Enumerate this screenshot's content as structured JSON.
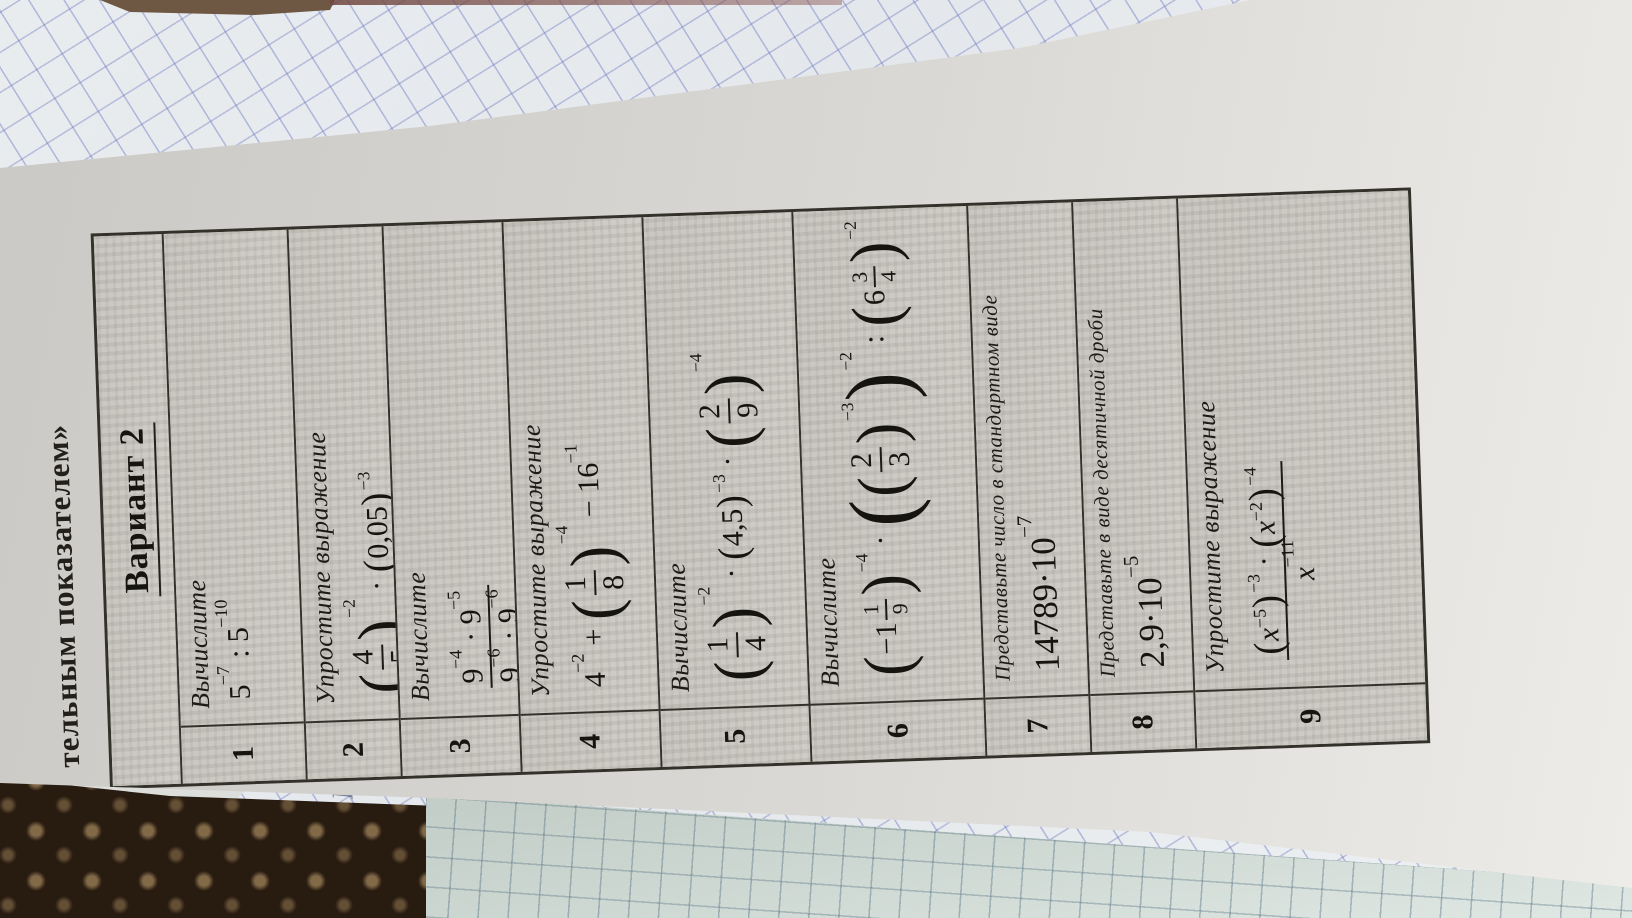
{
  "scene": {
    "page_title_fragment": "тельным показателем»",
    "handwriting_mark": "И"
  },
  "worksheet": {
    "variant_title": "Вариант 2",
    "problems": [
      {
        "num": "1",
        "instruction": "Вычислите",
        "formula": [
          {
            "t": "txt",
            "v": "5"
          },
          {
            "t": "sup",
            "v": "−7"
          },
          {
            "t": "txt",
            "v": " : 5"
          },
          {
            "t": "sup",
            "v": "−10"
          }
        ]
      },
      {
        "num": "2",
        "instruction": "Упростите выражение",
        "formula": [
          {
            "t": "group",
            "psize": 2,
            "exp": "−2",
            "c": [
              {
                "t": "frac",
                "num": [
                  {
                    "t": "txt",
                    "v": "4"
                  }
                ],
                "den": [
                  {
                    "t": "txt",
                    "v": "5"
                  }
                ]
              }
            ]
          },
          {
            "t": "txt",
            "v": " · "
          },
          {
            "t": "group",
            "psize": 1,
            "exp": "−3",
            "c": [
              {
                "t": "txt",
                "v": "0,05"
              }
            ]
          }
        ]
      },
      {
        "num": "3",
        "instruction": "Вычислите",
        "formula": [
          {
            "t": "frac",
            "num": [
              {
                "t": "txt",
                "v": "9"
              },
              {
                "t": "sup",
                "v": "−4"
              },
              {
                "t": "txt",
                "v": " · 9"
              },
              {
                "t": "sup",
                "v": "−5"
              }
            ],
            "den": [
              {
                "t": "txt",
                "v": "9"
              },
              {
                "t": "sup",
                "v": "−6"
              },
              {
                "t": "txt",
                "v": " · 9"
              },
              {
                "t": "sup",
                "v": "−6"
              }
            ]
          }
        ]
      },
      {
        "num": "4",
        "instruction": "Упростите выражение",
        "formula": [
          {
            "t": "txt",
            "v": "4"
          },
          {
            "t": "sup",
            "v": "−2"
          },
          {
            "t": "txt",
            "v": " + "
          },
          {
            "t": "group",
            "psize": 2,
            "exp": "−4",
            "c": [
              {
                "t": "frac",
                "num": [
                  {
                    "t": "txt",
                    "v": "1"
                  }
                ],
                "den": [
                  {
                    "t": "txt",
                    "v": "8"
                  }
                ]
              }
            ]
          },
          {
            "t": "txt",
            "v": " − 16"
          },
          {
            "t": "sup",
            "v": "−1"
          }
        ]
      },
      {
        "num": "5",
        "instruction": "Вычислите",
        "formula": [
          {
            "t": "group",
            "psize": 2,
            "exp": "−2",
            "c": [
              {
                "t": "frac",
                "num": [
                  {
                    "t": "txt",
                    "v": "1"
                  }
                ],
                "den": [
                  {
                    "t": "txt",
                    "v": "4"
                  }
                ]
              }
            ]
          },
          {
            "t": "txt",
            "v": " · "
          },
          {
            "t": "group",
            "psize": 1,
            "exp": "−3",
            "c": [
              {
                "t": "txt",
                "v": "4,5"
              }
            ]
          },
          {
            "t": "txt",
            "v": " · "
          },
          {
            "t": "group",
            "psize": 2,
            "exp": "−4",
            "c": [
              {
                "t": "frac",
                "num": [
                  {
                    "t": "txt",
                    "v": "2"
                  }
                ],
                "den": [
                  {
                    "t": "txt",
                    "v": "9"
                  }
                ]
              }
            ]
          }
        ]
      },
      {
        "num": "6",
        "instruction": "Вычислите",
        "formula": [
          {
            "t": "group",
            "psize": 2,
            "exp": "−4",
            "c": [
              {
                "t": "txt",
                "v": "−1"
              },
              {
                "t": "frac",
                "small": true,
                "num": [
                  {
                    "t": "txt",
                    "v": "1"
                  }
                ],
                "den": [
                  {
                    "t": "txt",
                    "v": "9"
                  }
                ]
              }
            ]
          },
          {
            "t": "txt",
            "v": " · "
          },
          {
            "t": "group",
            "psize": 3,
            "exp": "−2",
            "c": [
              {
                "t": "group",
                "psize": 2,
                "exp": "−3",
                "c": [
                  {
                    "t": "frac",
                    "num": [
                      {
                        "t": "txt",
                        "v": "2"
                      }
                    ],
                    "den": [
                      {
                        "t": "txt",
                        "v": "3"
                      }
                    ]
                  }
                ]
              }
            ]
          },
          {
            "t": "txt",
            "v": " : "
          },
          {
            "t": "group",
            "psize": 2,
            "exp": "−2",
            "c": [
              {
                "t": "txt",
                "v": "6"
              },
              {
                "t": "frac",
                "small": true,
                "num": [
                  {
                    "t": "txt",
                    "v": "3"
                  }
                ],
                "den": [
                  {
                    "t": "txt",
                    "v": "4"
                  }
                ]
              }
            ]
          }
        ]
      },
      {
        "num": "7",
        "instruction": "Представьте число в стандартном виде",
        "formula": [
          {
            "t": "txt",
            "v": "14789·10"
          },
          {
            "t": "sup",
            "v": "−7"
          }
        ]
      },
      {
        "num": "8",
        "instruction": "Представьте в виде десятичной дроби",
        "formula": [
          {
            "t": "txt",
            "v": "2,9·10"
          },
          {
            "t": "sup",
            "v": "−5"
          }
        ]
      },
      {
        "num": "9",
        "instruction": "Упростите выражение",
        "formula": [
          {
            "t": "frac",
            "num": [
              {
                "t": "group",
                "psize": 1,
                "exp": "−3",
                "c": [
                  {
                    "t": "var",
                    "v": "x"
                  },
                  {
                    "t": "sup",
                    "v": "−5"
                  }
                ]
              },
              {
                "t": "txt",
                "v": " · "
              },
              {
                "t": "group",
                "psize": 1,
                "exp": "−4",
                "c": [
                  {
                    "t": "var",
                    "v": "x"
                  },
                  {
                    "t": "sup",
                    "v": "−2"
                  }
                ]
              }
            ],
            "den": [
              {
                "t": "var",
                "v": "x"
              },
              {
                "t": "sup",
                "v": "−11"
              }
            ]
          }
        ]
      }
    ]
  }
}
